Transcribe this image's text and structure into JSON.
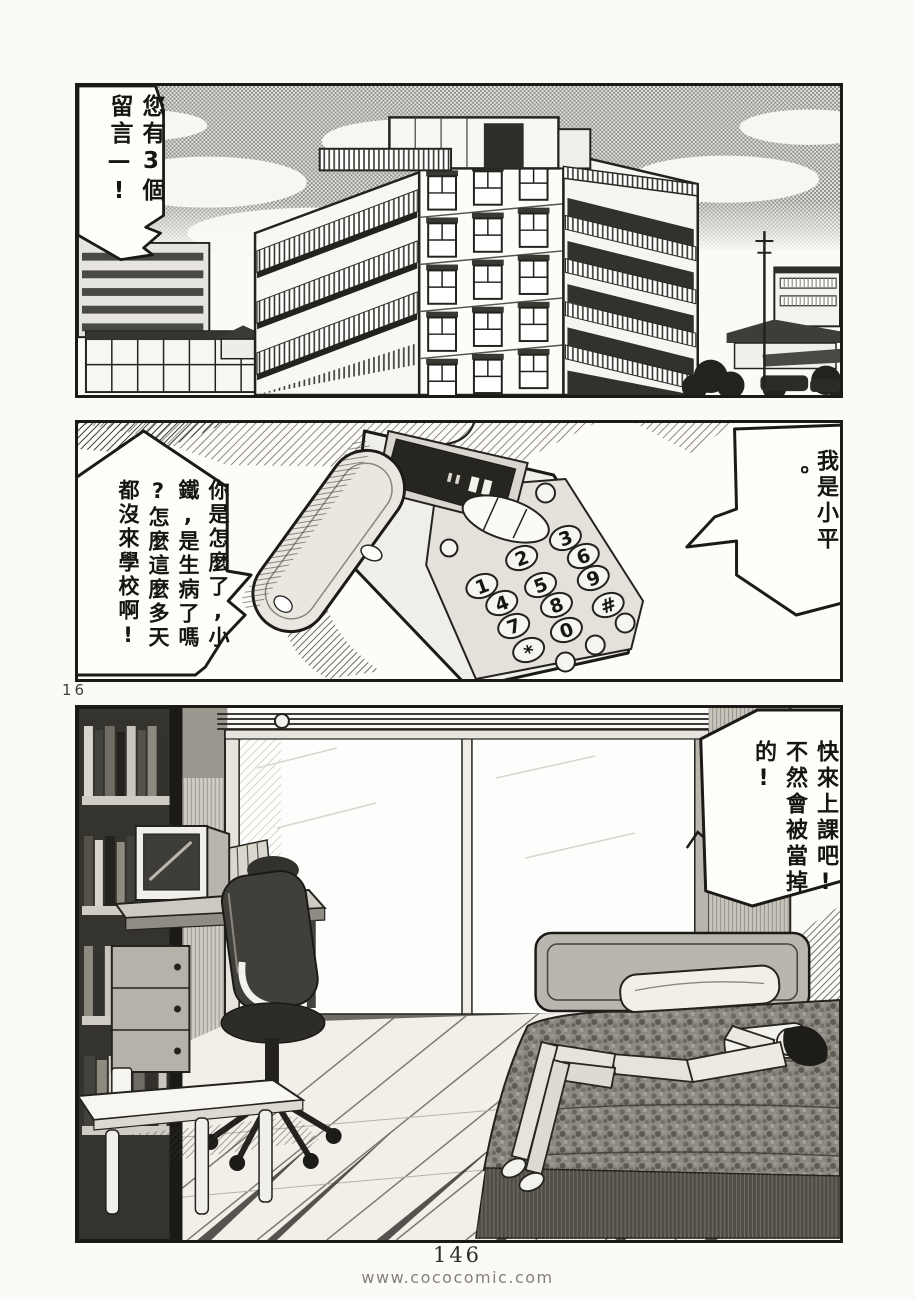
{
  "page": {
    "marker": "16",
    "number": "146",
    "watermark": "www.cococomic.com"
  },
  "colors": {
    "paper": "#fbfaf6",
    "ink": "#1b1a17",
    "halftone_sky": "#908e88"
  },
  "panel1": {
    "description": "city apartment buildings under halftone sky",
    "bubble": {
      "cols": [
        "您有3個",
        "留言—!"
      ]
    }
  },
  "panel2": {
    "description": "telephone answering machine close-up",
    "bubble_left": {
      "cols": [
        "你是怎麼了,小",
        "鐵,是生病了嗎",
        "?怎麼這麼多天",
        "都沒來學校啊!"
      ]
    },
    "bubble_right": {
      "cols": [
        "我是小平",
        "。"
      ]
    },
    "keypad": [
      "1",
      "2",
      "3",
      "4",
      "5",
      "6",
      "7",
      "8",
      "9",
      "*",
      "0",
      "#"
    ]
  },
  "panel3": {
    "description": "bedroom with boy lying on bed",
    "bubble": {
      "cols": [
        "快來上課吧!",
        "不然會被當掉",
        "的!"
      ]
    }
  }
}
